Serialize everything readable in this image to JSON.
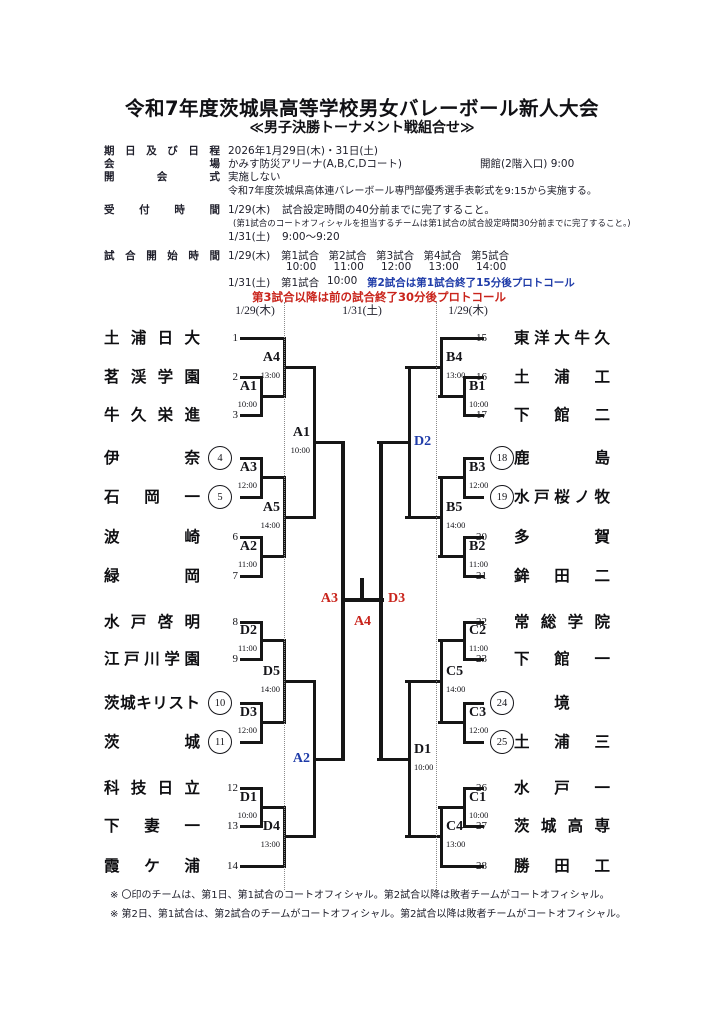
{
  "title": "令和7年度茨城県高等学校男女バレーボール新人大会",
  "subtitle": "≪男子決勝トーナメント戦組合せ≫",
  "colors": {
    "blue": "#1e3ba8",
    "red": "#c9241c",
    "line": "#161616"
  },
  "info": {
    "schedule_label": "期日及び日程",
    "schedule_value": "2026年1月29日(木)・31日(土)",
    "venue_label": "会場",
    "venue_value": "かみす防災アリーナ(A,B,C,Dコート)",
    "venue_note": "開館(2階入口) 9:00",
    "ceremony_label": "開会式",
    "ceremony_value": "実施しない",
    "ceremony_extra": "令和7年度茨城県高体連バレーボール専門部優秀選手表彰式を9:15から実施する。",
    "reception_label": "受付時間",
    "reception_day1": "1/29(木)",
    "reception_day1_value": "試合設定時間の40分前までに完了すること。",
    "reception_day1_note": "(第1試合のコートオフィシャルを担当するチームは第1試合の試合設定時間30分前までに完了すること。)",
    "reception_day2": "1/31(土)",
    "reception_day2_value": "9:00～9:20",
    "start_label": "試合開始時間",
    "start_day1": "1/29(木)",
    "start_day1_matches": [
      "第1試合",
      "第2試合",
      "第3試合",
      "第4試合",
      "第5試合"
    ],
    "start_day1_times": [
      "10:00",
      "11:00",
      "12:00",
      "13:00",
      "14:00"
    ],
    "start_day2": "1/31(土)",
    "start_day2_match": "第1試合",
    "start_day2_time": "10:00",
    "start_day2_blue": "第2試合は第1試合終了15分後プロトコール",
    "start_day2_red": "第3試合以降は前の試合終了30分後プロトコール"
  },
  "bracket": {
    "column_dates": [
      "1/29(木)",
      "1/31(土)",
      "1/29(木)"
    ],
    "left_teams": [
      {
        "num": "1",
        "name": "土浦日大",
        "circled": false
      },
      {
        "num": "2",
        "name": "茗渓学園",
        "circled": false
      },
      {
        "num": "3",
        "name": "牛久栄進",
        "circled": false
      },
      {
        "num": "4",
        "name": "伊奈",
        "circled": true
      },
      {
        "num": "5",
        "name": "石岡一",
        "circled": true
      },
      {
        "num": "6",
        "name": "波崎",
        "circled": false
      },
      {
        "num": "7",
        "name": "緑岡",
        "circled": false
      },
      {
        "num": "8",
        "name": "水戸啓明",
        "circled": false
      },
      {
        "num": "9",
        "name": "江戸川学園",
        "circled": false
      },
      {
        "num": "10",
        "name": "茨城キリスト",
        "circled": true
      },
      {
        "num": "11",
        "name": "茨城",
        "circled": true
      },
      {
        "num": "12",
        "name": "科技日立",
        "circled": false
      },
      {
        "num": "13",
        "name": "下妻一",
        "circled": false
      },
      {
        "num": "14",
        "name": "霞ケ浦",
        "circled": false
      }
    ],
    "right_teams": [
      {
        "num": "15",
        "name": "東洋大牛久",
        "circled": false
      },
      {
        "num": "16",
        "name": "土浦工",
        "circled": false
      },
      {
        "num": "17",
        "name": "下館二",
        "circled": false
      },
      {
        "num": "18",
        "name": "鹿島",
        "circled": true
      },
      {
        "num": "19",
        "name": "水戸桜ノ牧",
        "circled": true
      },
      {
        "num": "20",
        "name": "多賀",
        "circled": false
      },
      {
        "num": "21",
        "name": "鉾田二",
        "circled": false
      },
      {
        "num": "22",
        "name": "常総学院",
        "circled": false
      },
      {
        "num": "23",
        "name": "下館一",
        "circled": false
      },
      {
        "num": "24",
        "name": "境",
        "circled": true
      },
      {
        "num": "25",
        "name": "土浦三",
        "circled": true
      },
      {
        "num": "26",
        "name": "水戸一",
        "circled": false
      },
      {
        "num": "27",
        "name": "茨城高専",
        "circled": false
      },
      {
        "num": "28",
        "name": "勝田工",
        "circled": false
      }
    ],
    "left_r1": [
      {
        "code": "A1",
        "time": "10:00"
      },
      {
        "code": "A3",
        "time": "12:00"
      },
      {
        "code": "A2",
        "time": "11:00"
      },
      {
        "code": "D2",
        "time": "11:00"
      },
      {
        "code": "D3",
        "time": "12:00"
      },
      {
        "code": "D1",
        "time": "10:00"
      }
    ],
    "left_r2": [
      {
        "code": "A4",
        "time": "13:00"
      },
      {
        "code": "A5",
        "time": "14:00"
      },
      {
        "code": "D5",
        "time": "14:00"
      },
      {
        "code": "D4",
        "time": "13:00"
      }
    ],
    "left_qf": [
      {
        "code": "A1",
        "time": "10:00",
        "color": "black"
      },
      {
        "code": "A2",
        "time": "",
        "color": "blue"
      }
    ],
    "left_sf": {
      "code": "A3",
      "color": "red"
    },
    "right_r1": [
      {
        "code": "B1",
        "time": "10:00"
      },
      {
        "code": "B3",
        "time": "12:00"
      },
      {
        "code": "B2",
        "time": "11:00"
      },
      {
        "code": "C2",
        "time": "11:00"
      },
      {
        "code": "C3",
        "time": "12:00"
      },
      {
        "code": "C1",
        "time": "10:00"
      }
    ],
    "right_r2": [
      {
        "code": "B4",
        "time": "13:00"
      },
      {
        "code": "B5",
        "time": "14:00"
      },
      {
        "code": "C5",
        "time": "14:00"
      },
      {
        "code": "C4",
        "time": "13:00"
      }
    ],
    "right_qf": [
      {
        "code": "D2",
        "time": "",
        "color": "blue"
      },
      {
        "code": "D1",
        "time": "10:00",
        "color": "black"
      }
    ],
    "right_sf": {
      "code": "D3",
      "color": "red"
    },
    "final": {
      "code": "A4",
      "color": "red"
    }
  },
  "notes": [
    "※ 〇印のチームは、第1日、第1試合のコートオフィシャル。第2試合以降は敗者チームがコートオフィシャル。",
    "※ 第2日、第1試合は、第2試合のチームがコートオフィシャル。第2試合以降は敗者チームがコートオフィシャル。"
  ]
}
